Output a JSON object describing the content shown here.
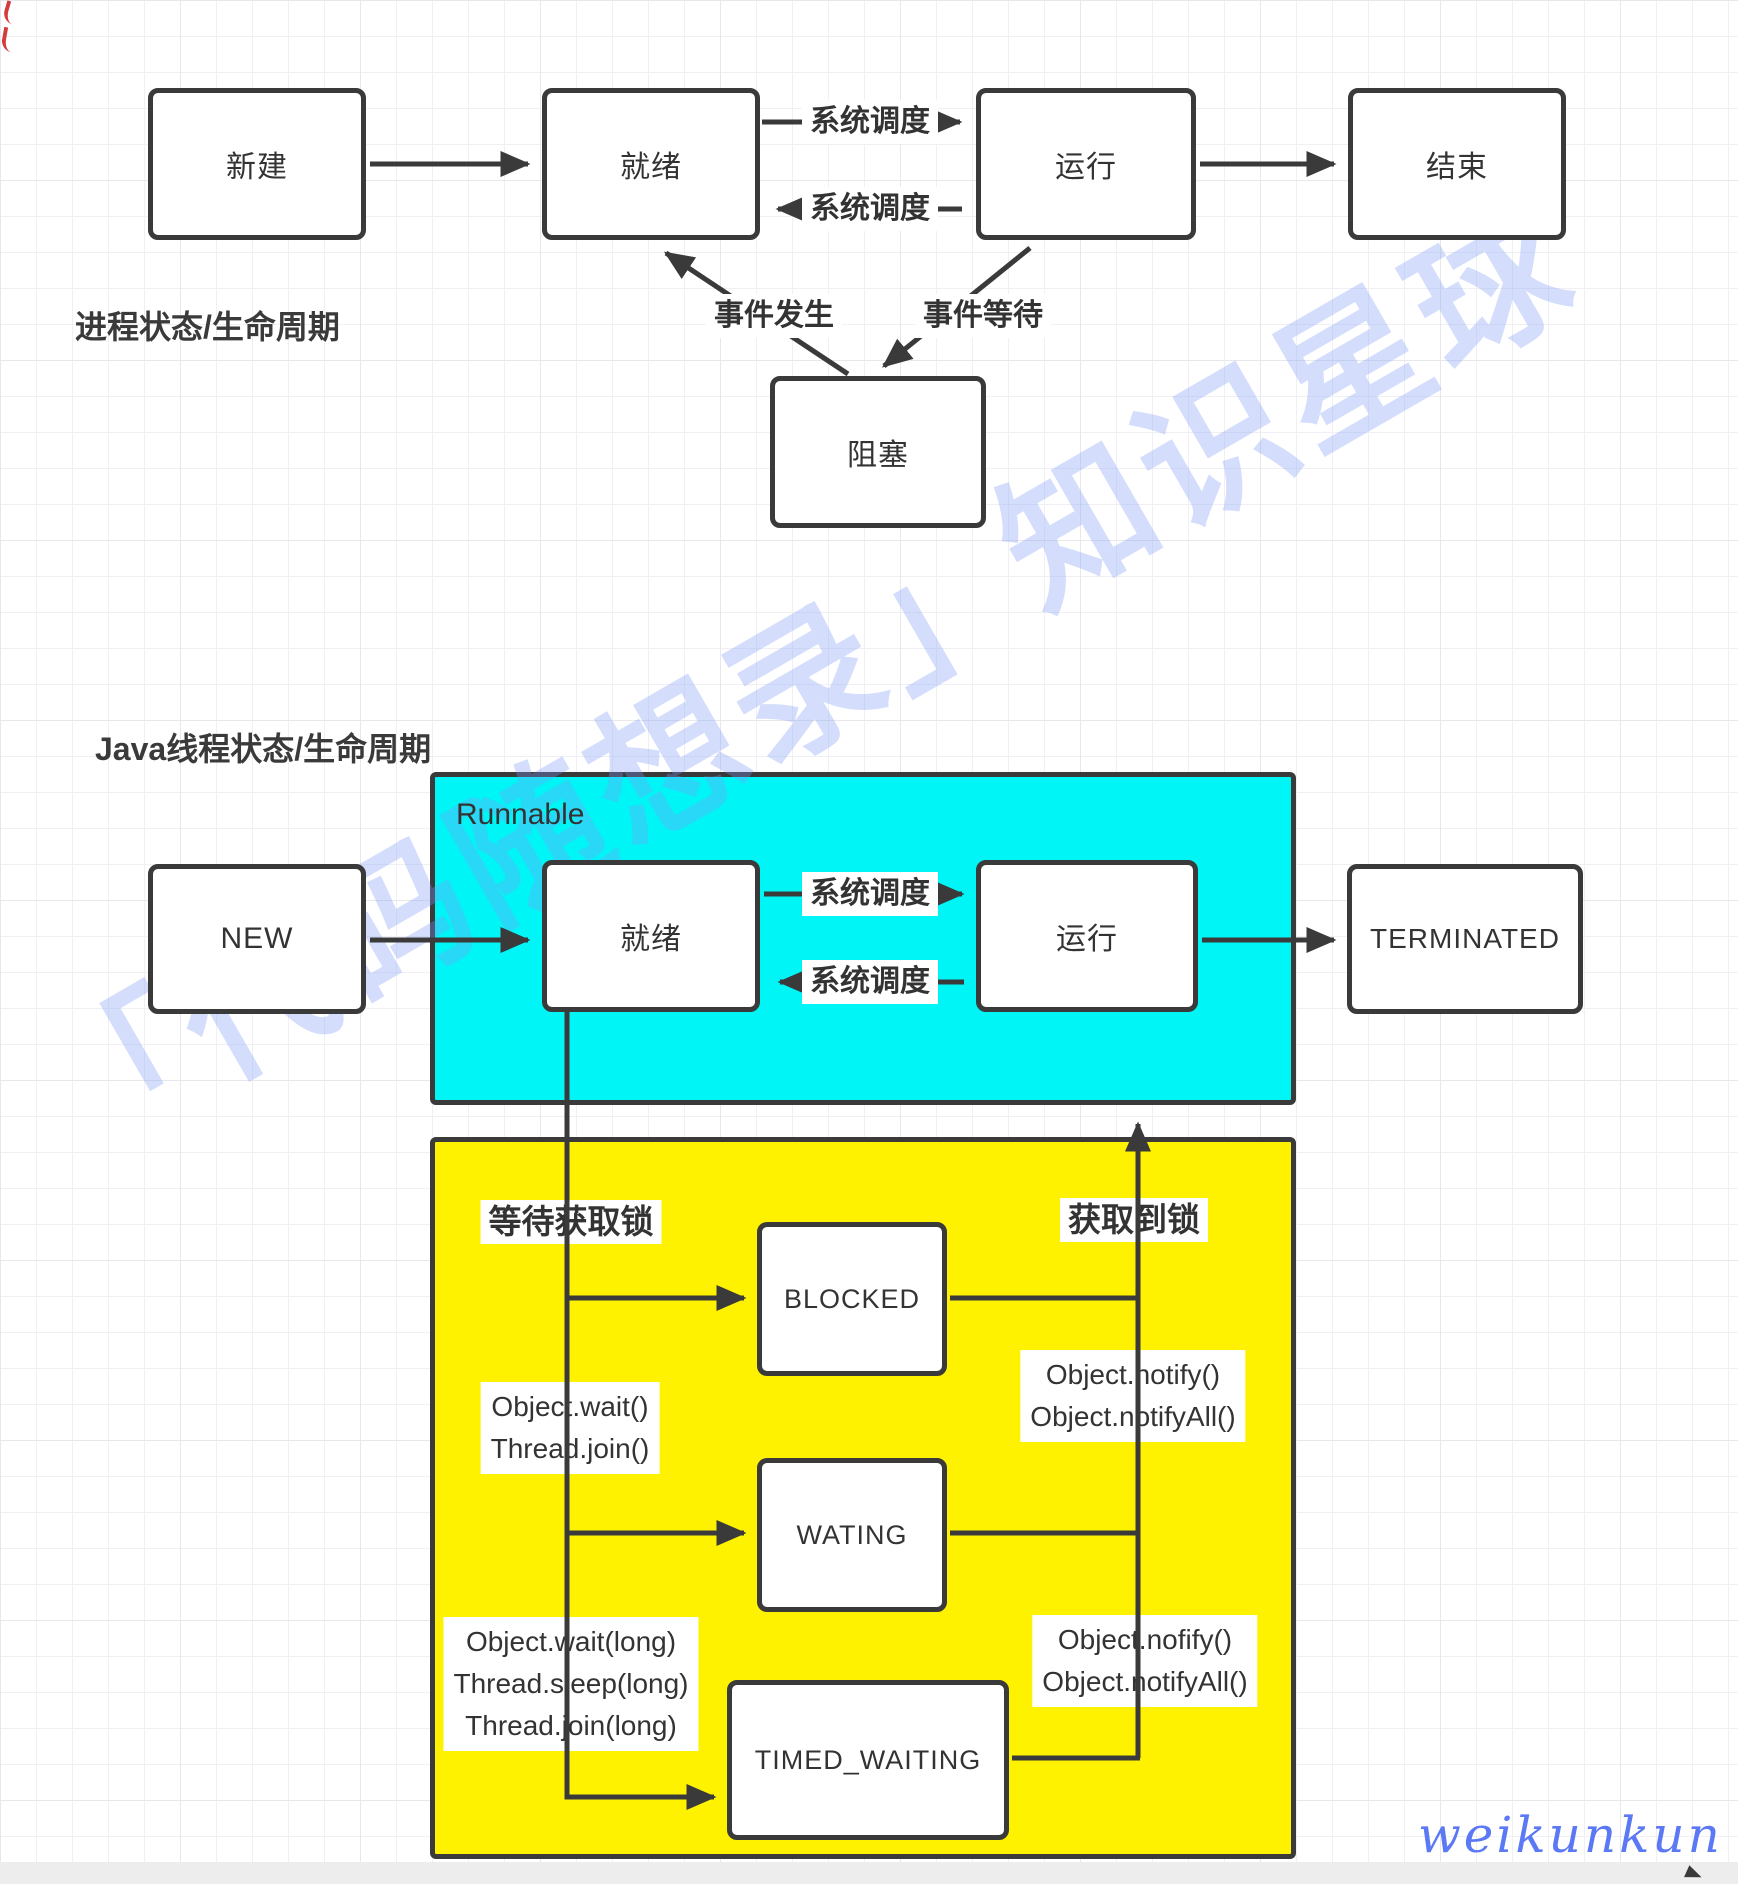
{
  "process": {
    "title": "进程状态/生命周期",
    "nodes": {
      "create": "新建",
      "ready": "就绪",
      "running": "运行",
      "end": "结束",
      "blocked": "阻塞"
    },
    "edges": {
      "ready_to_running": "系统调度",
      "running_to_ready": "系统调度",
      "event_occur": "事件发生",
      "event_wait": "事件等待"
    }
  },
  "java": {
    "title": "Java线程状态/生命周期",
    "runnable_group_label": "Runnable",
    "nodes": {
      "new": "NEW",
      "ready": "就绪",
      "running": "运行",
      "terminated": "TERMINATED",
      "blocked": "BLOCKED",
      "waiting": "WATING",
      "timed_waiting": "TIMED_WAITING"
    },
    "edges": {
      "ready_to_running": "系统调度",
      "running_to_ready": "系统调度",
      "wait_for_lock": "等待获取锁",
      "lock_acquired": "获取到锁",
      "to_waiting": "Object.wait()\nThread.join()",
      "waiting_to_runnable": "Object.notify()\nObject.notifyAll()",
      "to_timed_waiting": "Object.wait(long)\nThread.sleep(long)\nThread.join(long)",
      "timed_to_runnable": "Object.nofify()\nObject.notifyAll()"
    }
  },
  "watermarks": {
    "diagonal": "「代码随想录」知识星球",
    "signature": "weikunkun"
  },
  "colors": {
    "stroke": "#3A3A3A",
    "runnable_fill": "#00F6F6",
    "lock_group_fill": "#FFF200",
    "watermark_blue": "#7D9BF5",
    "signature_blue": "#5B78F5"
  }
}
